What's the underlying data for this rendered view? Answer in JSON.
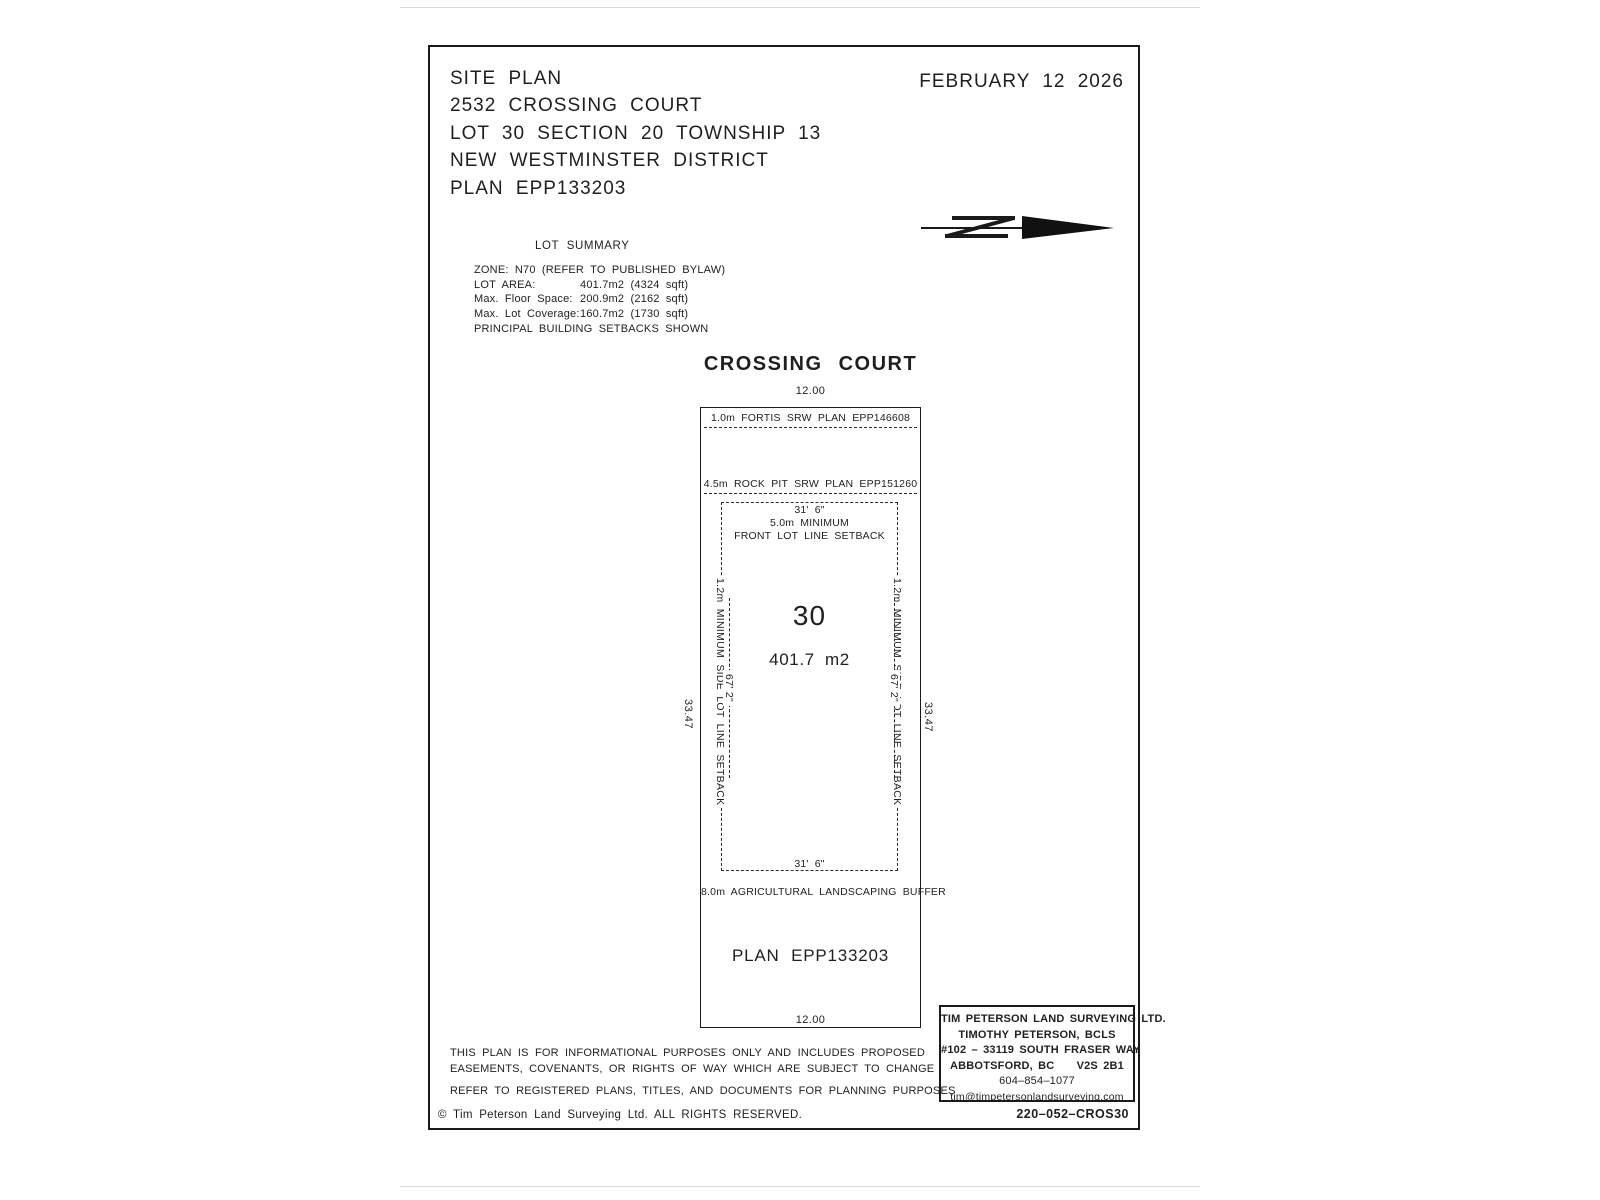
{
  "header": {
    "lines": [
      "SITE PLAN",
      "2532 CROSSING COURT",
      "LOT 30 SECTION 20 TOWNSHIP 13",
      "NEW WESTMINSTER DISTRICT",
      "PLAN EPP133203"
    ],
    "date": "FEBRUARY 12 2026"
  },
  "lot_summary": {
    "title": "LOT SUMMARY",
    "zone": "ZONE: N70 (REFER TO PUBLISHED BYLAW)",
    "rows": [
      {
        "label": "LOT AREA:",
        "value": "401.7m2 (4324 sqft)"
      },
      {
        "label": "Max. Floor Space:",
        "value": "200.9m2 (2162 sqft)"
      },
      {
        "label": "Max. Lot Coverage:",
        "value": "160.7m2 (1730 sqft)"
      }
    ],
    "note": "PRINCIPAL BUILDING SETBACKS SHOWN"
  },
  "plan": {
    "street": "CROSSING COURT",
    "front_width": "12.00",
    "rear_width": "12.00",
    "left_depth": "33.47",
    "right_depth": "33.47",
    "srw1": "1.0m FORTIS SRW PLAN EPP146608",
    "srw2": "4.5m ROCK PIT SRW PLAN EPP151260",
    "front_setback": {
      "dim": "31' 6\"",
      "line1": "5.0m MINIMUM",
      "line2": "FRONT LOT LINE SETBACK"
    },
    "lot_number": "30",
    "lot_area": "401.7 m2",
    "side_left": {
      "setback": "1.2m MINIMUM SIDE LOT LINE SETBACK",
      "dim": "67' 2\""
    },
    "side_right": {
      "setback": "1.2m MINIMUM SIDE LOT LINE SETBACK",
      "dim": "67' 2\""
    },
    "rear_dim": "31' 6\"",
    "rear_buffer": "8.0m AGRICULTURAL LANDSCAPING BUFFER",
    "plan_label": "PLAN EPP133203"
  },
  "title_block": {
    "company": "TIM PETERSON LAND SURVEYING LTD.",
    "surveyor": "TIMOTHY PETERSON, BCLS",
    "address1": "#102 – 33119 SOUTH FRASER WAY",
    "city": "ABBOTSFORD, BC",
    "postal": "V2S 2B1",
    "phone": "604–854–1077",
    "email": "tim@timpetersonlandsurveying.com",
    "job_number": "220–052–CROS30"
  },
  "notes": {
    "line1": "THIS PLAN IS FOR INFORMATIONAL PURPOSES ONLY AND INCLUDES PROPOSED",
    "line2": "EASEMENTS, COVENANTS, OR RIGHTS OF WAY WHICH ARE SUBJECT TO CHANGE",
    "line3": "REFER TO REGISTERED PLANS, TITLES, AND DOCUMENTS FOR PLANNING PURPOSES"
  },
  "footer": {
    "copyright": "© Tim Peterson Land Surveying Ltd.  ALL RIGHTS RESERVED."
  },
  "icons": {
    "north_arrow": "north-arrow-icon"
  },
  "colors": {
    "ink": "#1f1f1f",
    "paper": "#ffffff",
    "separator": "#d9d9d9"
  }
}
